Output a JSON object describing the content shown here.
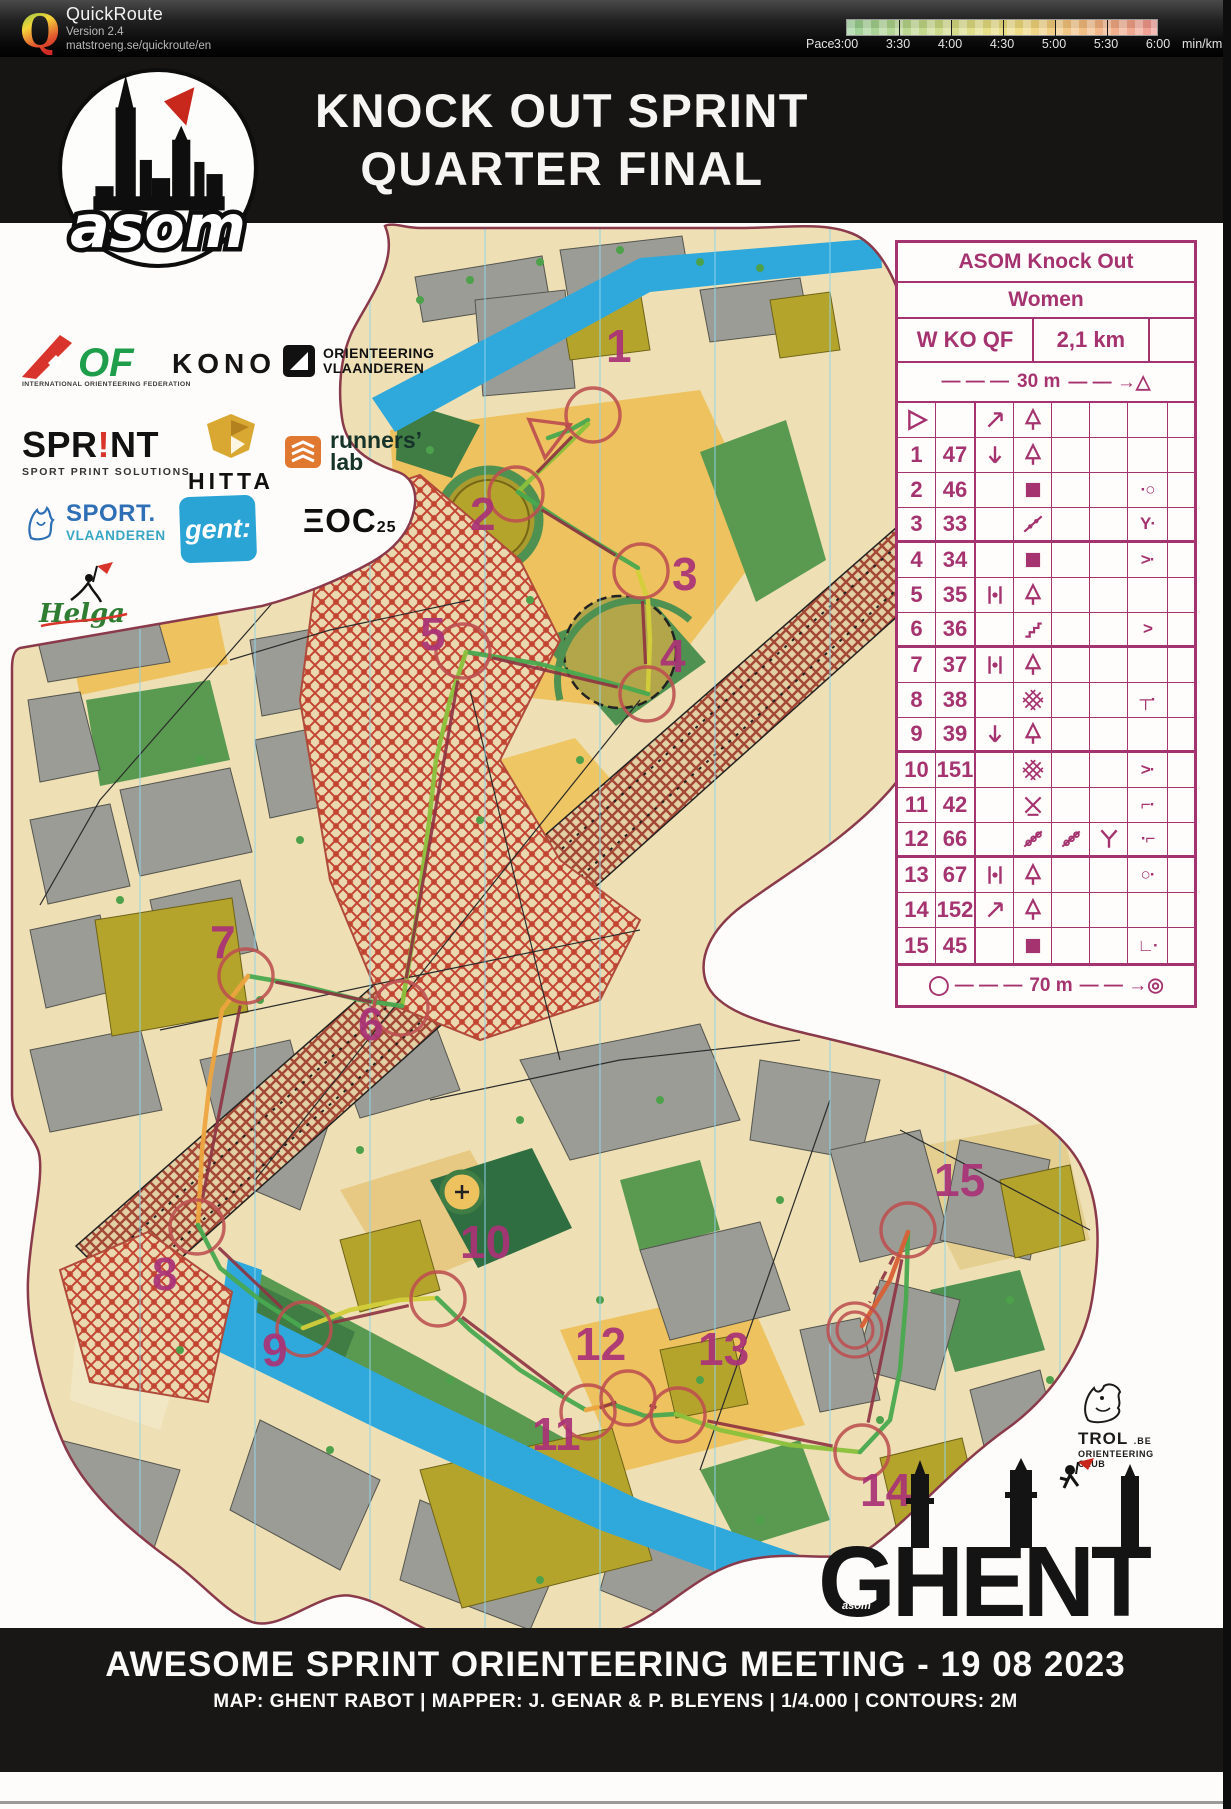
{
  "header": {
    "app_title": "QuickRoute",
    "version": "Version 2.4",
    "url": "matstroeng.se/quickroute/en",
    "pace_label": "Pace",
    "pace_unit": "min/km",
    "pace_ticks": [
      "3:00",
      "3:30",
      "4:00",
      "4:30",
      "5:00",
      "5:30",
      "6:00"
    ]
  },
  "title": {
    "line1": "KNOCK OUT SPRINT",
    "line2": "QUARTER FINAL",
    "logo_word": "asom"
  },
  "sponsors": {
    "iof_name": "OF",
    "iof_tagline": "INTERNATIONAL ORIENTEERING FEDERATION",
    "kono": "KONO",
    "ovl_line1": "ORIENTEERING",
    "ovl_line2": "VLAANDEREN",
    "sprint": "SPR!NT",
    "sprint_tagline": "SPORT PRINT SOLUTIONS",
    "hitta": "HITTA",
    "runners_line1": "runners’",
    "runners_line2": "lab",
    "sport_line1": "SPORT.",
    "sport_line2": "VLAANDEREN",
    "gent": "gent:",
    "eoc": "ΞOC",
    "eoc_nr": "25",
    "helga": "Helga"
  },
  "control_card": {
    "title": "ASOM Knock Out",
    "class_name": "Women",
    "course_code": "W KO QF",
    "course_length": "2,1 km",
    "start_row": {
      "pre": "— — —",
      "dist": "30 m",
      "post": "— — →△"
    },
    "finish_row": {
      "pre": "◯ — — —",
      "dist": "70 m",
      "post": "— — →◎"
    },
    "rows": [
      {
        "a": "start",
        "b": "",
        "c": "arrow-ne",
        "d": "conifer",
        "e": "",
        "f": "",
        "g": ""
      },
      {
        "a": "1",
        "b": "47",
        "c": "arrow-s",
        "d": "conifer",
        "e": "",
        "f": "",
        "g": ""
      },
      {
        "a": "2",
        "b": "46",
        "c": "",
        "d": "building",
        "e": "",
        "f": "",
        "g": "·○"
      },
      {
        "a": "3",
        "b": "33",
        "c": "",
        "d": "fence",
        "e": "",
        "f": "",
        "g": "Y·"
      },
      {
        "a": "4",
        "b": "34",
        "c": "",
        "d": "building",
        "e": "",
        "f": "",
        "g": ">·"
      },
      {
        "a": "5",
        "b": "35",
        "c": "between",
        "d": "conifer",
        "e": "",
        "f": "",
        "g": ""
      },
      {
        "a": "6",
        "b": "36",
        "c": "",
        "d": "stairs",
        "e": "",
        "f": "",
        "g": ">"
      },
      {
        "a": "7",
        "b": "37",
        "c": "between",
        "d": "conifer",
        "e": "",
        "f": "",
        "g": ""
      },
      {
        "a": "8",
        "b": "38",
        "c": "",
        "d": "canopy",
        "e": "",
        "f": "",
        "g": "┬·"
      },
      {
        "a": "9",
        "b": "39",
        "c": "arrow-s",
        "d": "conifer",
        "e": "",
        "f": "",
        "g": ""
      },
      {
        "a": "10",
        "b": "151",
        "c": "",
        "d": "canopy",
        "e": "",
        "f": "",
        "g": ">·"
      },
      {
        "a": "11",
        "b": "42",
        "c": "",
        "d": "special",
        "e": "",
        "f": "",
        "g": "⌐·"
      },
      {
        "a": "12",
        "b": "66",
        "c": "",
        "d": "fence-o",
        "e": "fence-o",
        "f": "junction-y",
        "g": "·⌐"
      },
      {
        "a": "13",
        "b": "67",
        "c": "between",
        "d": "conifer",
        "e": "",
        "f": "",
        "g": "○·"
      },
      {
        "a": "14",
        "b": "152",
        "c": "arrow-ne",
        "d": "conifer",
        "e": "",
        "f": "",
        "g": ""
      },
      {
        "a": "15",
        "b": "45",
        "c": "",
        "d": "building",
        "e": "",
        "f": "",
        "g": "∟·"
      }
    ]
  },
  "course": {
    "start": {
      "x": 548,
      "y": 434
    },
    "finish": {
      "x": 855,
      "y": 1330
    },
    "controls": [
      {
        "n": "1",
        "cx": 593,
        "cy": 415,
        "lx": 606,
        "ly": 362
      },
      {
        "n": "2",
        "cx": 516,
        "cy": 494,
        "lx": 470,
        "ly": 530
      },
      {
        "n": "3",
        "cx": 641,
        "cy": 571,
        "lx": 672,
        "ly": 590
      },
      {
        "n": "4",
        "cx": 647,
        "cy": 694,
        "lx": 660,
        "ly": 672
      },
      {
        "n": "5",
        "cx": 463,
        "cy": 651,
        "lx": 420,
        "ly": 650
      },
      {
        "n": "6",
        "cx": 401,
        "cy": 1008,
        "lx": 358,
        "ly": 1040
      },
      {
        "n": "7",
        "cx": 246,
        "cy": 976,
        "lx": 210,
        "ly": 958
      },
      {
        "n": "8",
        "cx": 197,
        "cy": 1227,
        "lx": 152,
        "ly": 1290
      },
      {
        "n": "9",
        "cx": 304,
        "cy": 1329,
        "lx": 262,
        "ly": 1366
      },
      {
        "n": "10",
        "cx": 438,
        "cy": 1299,
        "lx": 460,
        "ly": 1258
      },
      {
        "n": "11",
        "cx": 588,
        "cy": 1412,
        "lx": 532,
        "ly": 1450
      },
      {
        "n": "12",
        "cx": 628,
        "cy": 1398,
        "lx": 575,
        "ly": 1360
      },
      {
        "n": "13",
        "cx": 678,
        "cy": 1415,
        "lx": 698,
        "ly": 1365
      },
      {
        "n": "14",
        "cx": 862,
        "cy": 1452,
        "lx": 860,
        "ly": 1506
      },
      {
        "n": "15",
        "cx": 908,
        "cy": 1230,
        "lx": 934,
        "ly": 1196
      }
    ]
  },
  "footer": {
    "line1": "AWESOME SPRINT ORIENTEERING MEETING - 19 08 2023",
    "line2": "MAP: GHENT RABOT   |   MAPPER: J. GENAR & P. BLEYENS   |   1/4.000   |   CONTOURS: 2M"
  },
  "branding": {
    "ghent": "GHENT",
    "ghent_small": "asom",
    "trol_name": "TROL",
    "trol_be": ".BE",
    "trol_sub1": "ORIENTEERING",
    "trol_sub2": "CLUB"
  }
}
